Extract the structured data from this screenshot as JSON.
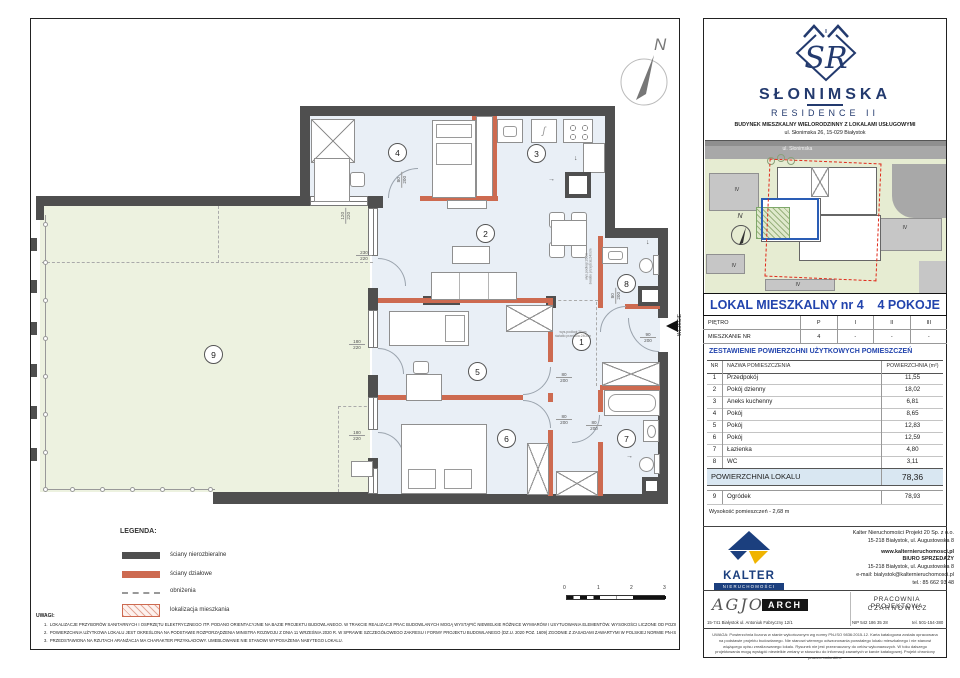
{
  "logo": {
    "monogram": "SR",
    "roof_mark": "II",
    "title": "SŁONIMSKA",
    "subtitle": "RESIDENCE II",
    "desc1": "BUDYNEK MIESZKALNY WIELORODZINNY Z LOKALAMI USŁUGOWYMI",
    "desc2": "ul. Słonimska 26, 15-029 Białystok"
  },
  "map": {
    "street": "ul. Słonimska",
    "north": "N",
    "iv": [
      "IV",
      "IV",
      "IV",
      "IV"
    ]
  },
  "unit": {
    "title": "LOKAL MIESZKALNY  nr 4",
    "rooms": "4 POKOJE"
  },
  "floors": {
    "row1": [
      "PIĘTRO",
      "P",
      "I",
      "II",
      "III"
    ],
    "row2": [
      "MIESZKANIE NR",
      "4",
      "-",
      "-",
      "-"
    ]
  },
  "areas": {
    "title": "ZESTAWIENIE POWIERZCHNI UŻYTKOWYCH POMIESZCZEŃ",
    "col_nr": "NR",
    "col_name": "NAZWA POMIESZCZENIA",
    "col_area": "POWIERZCHNIA (m²)",
    "rows": [
      {
        "nr": "1",
        "name": "Przedpokój",
        "area": "11,55"
      },
      {
        "nr": "2",
        "name": "Pokój dzienny",
        "area": "18,02"
      },
      {
        "nr": "3",
        "name": "Aneks kuchenny",
        "area": "6,81"
      },
      {
        "nr": "4",
        "name": "Pokój",
        "area": "8,65"
      },
      {
        "nr": "5",
        "name": "Pokój",
        "area": "12,83"
      },
      {
        "nr": "6",
        "name": "Pokój",
        "area": "12,59"
      },
      {
        "nr": "7",
        "name": "Łazienka",
        "area": "4,80"
      },
      {
        "nr": "8",
        "name": "WC",
        "area": "3,11"
      }
    ],
    "total_label": "POWIERZCHNIA LOKALU",
    "total": "78,36",
    "garden_nr": "9",
    "garden_name": "Ogródek",
    "garden_area": "78,93",
    "height_note": "Wysokość pomieszczeń - 2,68 m"
  },
  "plan": {
    "north": "N",
    "entrance": "WEJŚCIE",
    "room_numbers": [
      "1",
      "2",
      "3",
      "4",
      "5",
      "6",
      "7",
      "8",
      "9"
    ],
    "dims": [
      {
        "a": "120",
        "b": "220"
      },
      {
        "a": "230",
        "b": "220"
      },
      {
        "a": "180",
        "b": "220"
      },
      {
        "a": "180",
        "b": "220"
      },
      {
        "a": "80",
        "b": "200"
      },
      {
        "a": "80",
        "b": "200"
      },
      {
        "a": "80",
        "b": "200"
      },
      {
        "a": "80",
        "b": "200"
      },
      {
        "a": "80",
        "b": "200"
      },
      {
        "a": "90",
        "b": "200"
      }
    ],
    "note1": "wys.podłogi:26cm",
    "note2": "światło przejścia:240cm",
    "scale": [
      "0",
      "1",
      "2",
      "3"
    ],
    "legend": {
      "title": "LEGENDA:",
      "items": [
        "ściany nierozbieralne",
        "ściany działowe",
        "obniżenia",
        "lokalizacja mieszkania"
      ]
    }
  },
  "notes": {
    "title": "UWAGI:",
    "items": [
      {
        "n": "1.",
        "t": "LOKALIZACJE PRZYBORÓW SANITARNYCH I OSPRZĘTU ELEKTRYCZNEGO ITP. PODANO ORIENTACYJNIE NA BAZIE PROJEKTU BUDOWLANEGO. W TRAKCIE REALIZACJI PRAC BUDOWLANYCH MOGĄ WYSTĄPIĆ NIEWIELKIE RÓŻNICE WYMIARÓW I USYTUOWANIA ELEMENTÓW. WYSOKOŚCI LICZONE OD POZIOMU DOCELOWEGO WYKOŃCZENIA PODŁOGI."
      },
      {
        "n": "2.",
        "t": "POWIERZCHNIA UŻYTKOWA LOKALU JEST OKREŚLONA NA PODSTAWIE ROZPORZĄDZENIA MINISTRA ROZWOJU Z DNIA 11 WRZEŚNIA 2020 R. W SPRAWIE SZCZEGÓŁOWEGO ZAKRESU I FORMY PROJEKTU BUDOWLANEGO (DZ.U. 2020 POZ. 1609) ZGODNIE Z ZASADAMI ZAWARTYMI W POLSKIEJ NORMIE PN-ISO 9836:2015-12."
      },
      {
        "n": "3.",
        "t": "PRZEDSTAWIONA NA RZUTACH ARANŻACJA MA CHARAKTER PRZYKŁADOWY. UMEBLOWANIE NIE STANOWI WYPOSAŻENIA NABYTEGO LOKALU."
      }
    ]
  },
  "footer": {
    "kalter_name": "KALTER",
    "kalter_sub": "NIERUCHOMOŚCI",
    "k1": "Kalter Nieruchomości Projekt 20  Sp. z o.o.",
    "k2": "15-218 Białystok, ul. Augustowska 8",
    "k3": "www.kalternieruchomosci.pl",
    "k4": "BIURO SPRZEDAŻY",
    "k5": "15-218 Białystok, ul. Augustowska 8",
    "k6": "e-mail: bialystok@kalternieruchomosci.pl",
    "k7": "tel.: 85 662 93 48",
    "agjo": "AGJO",
    "arch": "ARCH",
    "agjo_address": "15-741 Białystok   ul. Antoniuk Fabryczny  12/1",
    "studio1": "PRACOWNIA PROJEKTOWA",
    "studio2": "C Z A R N O W I C Z",
    "nip": "NIP  542 186 35 28",
    "tel": "tel. 501-154-380",
    "disclaimer": "UWAGA:  Powierzchnia liczona w stanie wykończonym wg normy PN-ISO 9836:2015-12. Karta katalogowa została opracowana na podstawie projektu budowlanego. Nie stanowi wiernego odwzorowania powstałego lokalu mieszkalnego i nie stanowi wiążącego opisu zrealizowanego lokalu. Rysunek nie jest przeznaczony do celów wykonawczych. W toku dalszego projektowania mogą wystąpić niewielkie zmiany w stosunku do informacji zawartych w karcie katalogowej. Projekt chroniony prawem autorskim."
  }
}
